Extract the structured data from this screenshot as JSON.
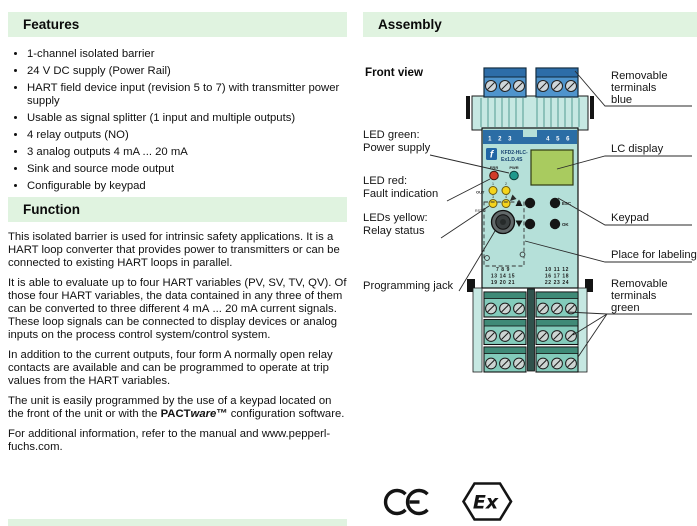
{
  "colors": {
    "section_header_bg": "#e0f3e0",
    "device_body": "#b5e0d9",
    "device_top": "#c6e8e2",
    "terminal_blue": "#4f94cc",
    "terminal_green": "#83cbbb",
    "number_strip_blue": "#2b6da5",
    "lc_display_green": "#a9cb5f",
    "led_red": "#d13c2a",
    "led_green": "#1d998c",
    "led_yellow": "#f4d41c"
  },
  "features": {
    "heading": "Features",
    "items": [
      "1-channel isolated barrier",
      "24 V DC supply (Power Rail)",
      "HART field device input (revision 5 to 7) with transmitter power supply",
      "Usable as signal splitter (1 input and multiple outputs)",
      "4 relay outputs (NO)",
      "3 analog outputs 4 mA ... 20 mA",
      "Sink and source mode output",
      "Configurable by keypad"
    ]
  },
  "function": {
    "heading": "Function",
    "p1": "This isolated barrier is used for intrinsic safety applications. It is a HART loop converter that provides power to transmitters or can be connected to existing HART loops in parallel.",
    "p2": "It is able to evaluate up to four HART variables (PV, SV, TV, QV). Of those four HART variables, the data contained in any three of them can be converted to three different 4 mA ... 20 mA current signals. These loop signals can be connected to display devices or analog inputs on the process control system/control system.",
    "p3": "In addition to the current outputs, four form A normally open relay contacts are available and can be programmed to operate at trip values from the HART variables.",
    "p4": {
      "before": "The unit is easily programmed by the use of a keypad located on the front of the unit or with the ",
      "brand_bold": "PACT",
      "brand_italic": "ware",
      "trademark": "™",
      "after": " configuration software."
    },
    "p5": "For additional information, refer to the manual and www.pepperl-fuchs.com."
  },
  "assembly": {
    "heading": "Assembly",
    "front_view": "Front view",
    "labels": {
      "terminals_blue": [
        "Removable",
        "terminals",
        "blue"
      ],
      "lc_display": "LC display",
      "led_green": [
        "LED green:",
        "Power supply"
      ],
      "led_red": [
        "LED red:",
        "Fault indication"
      ],
      "leds_yellow": [
        "LEDs yellow:",
        "Relay status"
      ],
      "keypad": "Keypad",
      "place_for_labeling": "Place for labeling",
      "programming_jack": "Programming jack",
      "terminals_green": [
        "Removable",
        "terminals",
        "green"
      ]
    },
    "device": {
      "logo_letter": "f",
      "model_line1": "KFD2-HLC-",
      "model_line2": "Ex1.D.4S",
      "led_err": "ERR",
      "led_pwr": "PWR",
      "out": "OUT",
      "out_led_numbers": [
        "1",
        "2",
        "3",
        "4"
      ],
      "esc": "ESC",
      "ok": "OK",
      "rs232": "RS232",
      "top_terminals_left": "1 2 3",
      "top_terminals_right": "4 5 6",
      "bottom_terminals_left": [
        "7 8 9",
        "13 14 15",
        "19 20 21"
      ],
      "bottom_terminals_right": [
        "10 11 12",
        "16 17 18",
        "22 23 24"
      ]
    },
    "marks": {
      "ce": "CE",
      "ex": "Ex"
    }
  }
}
